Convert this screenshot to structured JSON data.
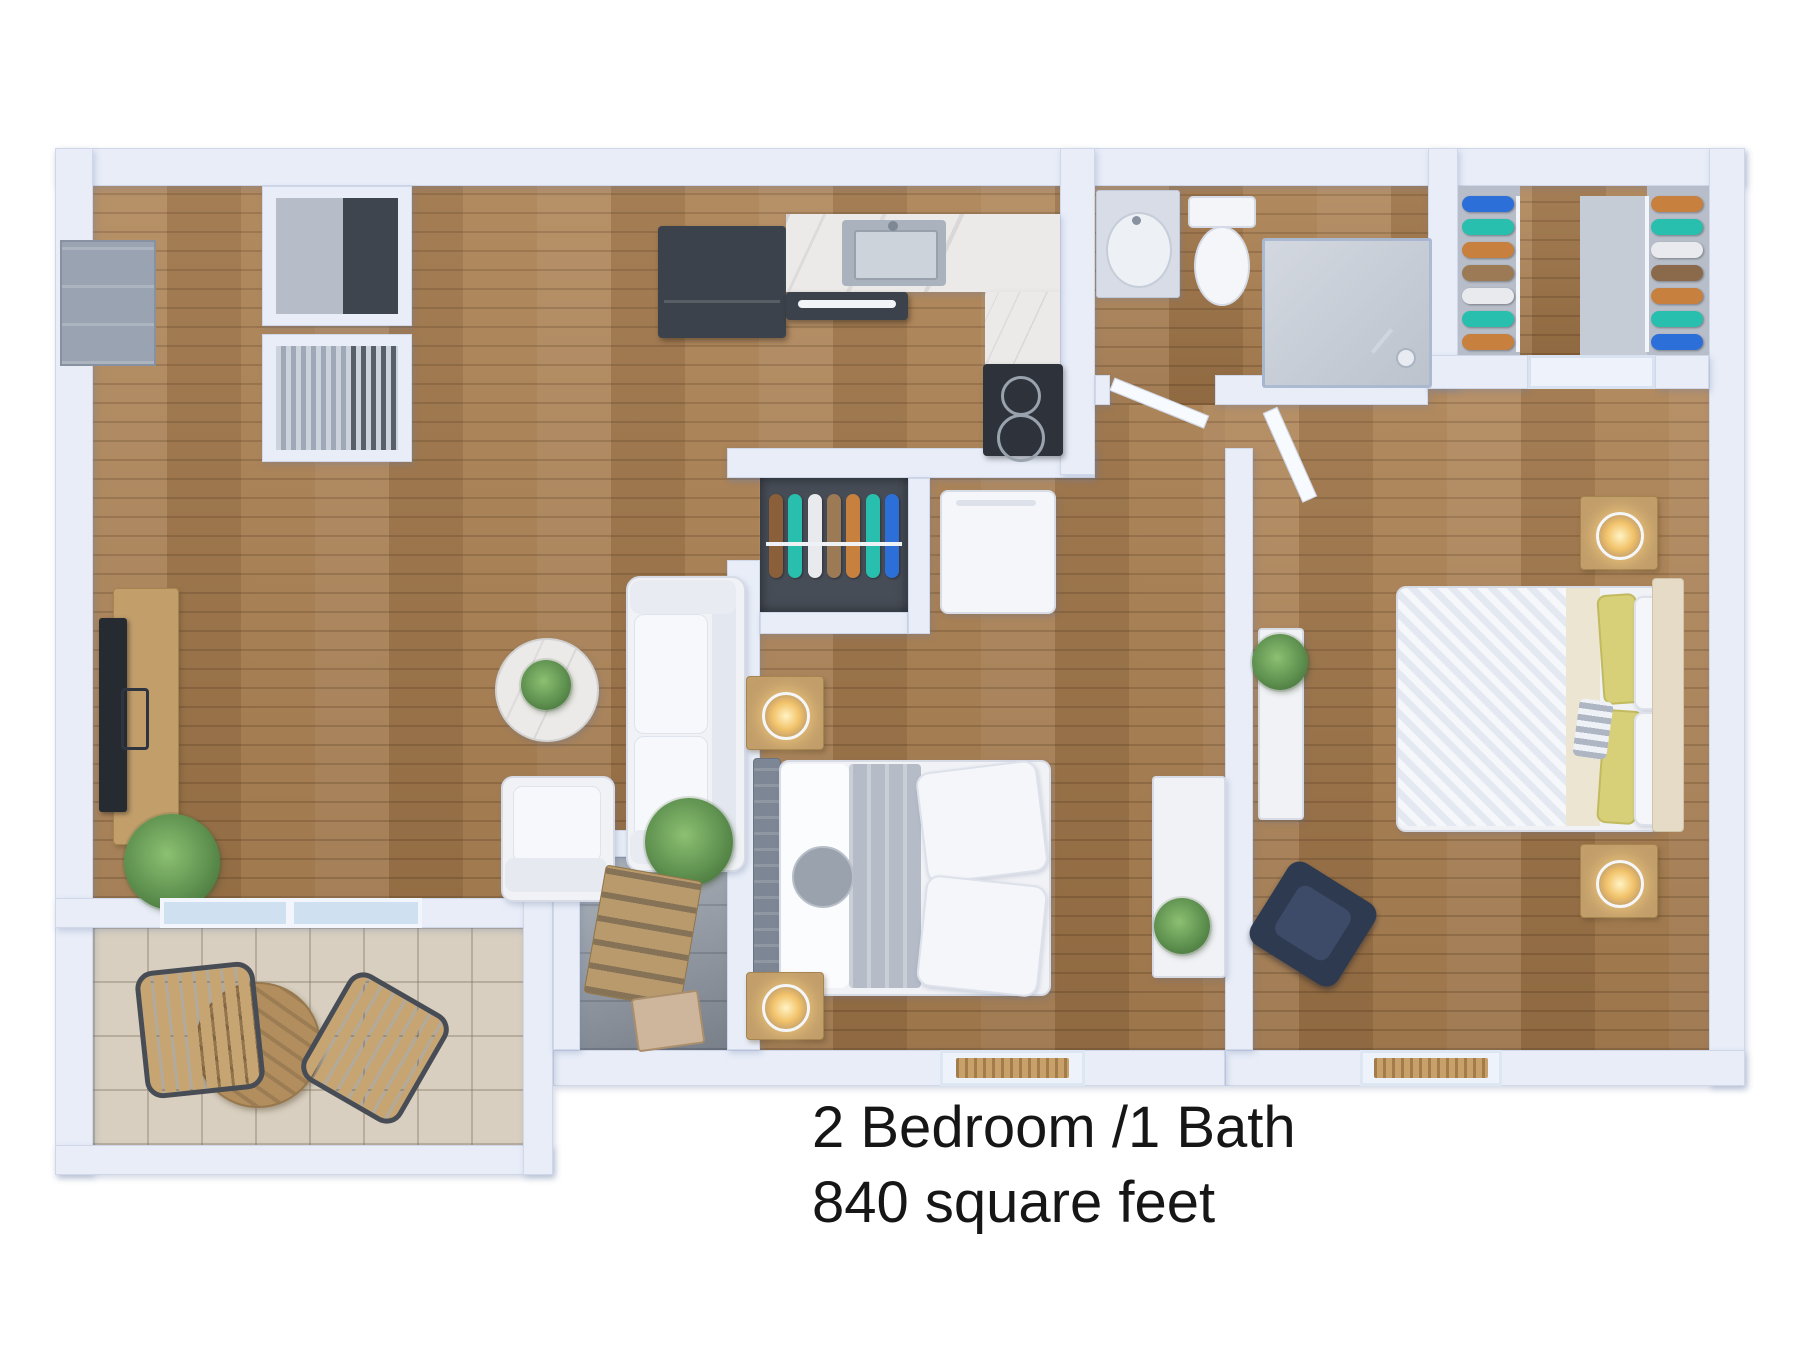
{
  "caption": {
    "line1": "2 Bedroom /1 Bath",
    "line2": "840 square feet"
  },
  "palette": {
    "background": "#ffffff",
    "wall": "#e8edf8",
    "wood_floor": "#a97c4c",
    "balcony_tile": "#d8cfc0",
    "nook_tile": "#9aa2ac",
    "marble": "#eceae8",
    "appliance_dark": "#3c424b",
    "furniture_white": "#f1f2f6",
    "furniture_wood": "#c29e6b",
    "plant_green": "#5f9150",
    "accent_yellow": "#d8d079",
    "navy_chair": "#2e3a50",
    "glass": "#cfe0f0",
    "headboard_grey": "#7d8694",
    "headboard_cream": "#e5dbc6",
    "text": "#161616"
  },
  "closets": {
    "walkin_left": [
      "#2d6fd8",
      "#28bfae",
      "#c8803e",
      "#9b7a55",
      "#e9eaee",
      "#28bfae",
      "#c8803e"
    ],
    "walkin_right": [
      "#c8803e",
      "#28bfae",
      "#e9eaee",
      "#8a6a4a",
      "#c8803e",
      "#28bfae",
      "#2d6fd8"
    ],
    "bedroom1_rack": [
      "#8a5f3a",
      "#28bfae",
      "#e9eaee",
      "#9b7a55",
      "#c8803e",
      "#28bfae",
      "#2d6fd8"
    ]
  }
}
